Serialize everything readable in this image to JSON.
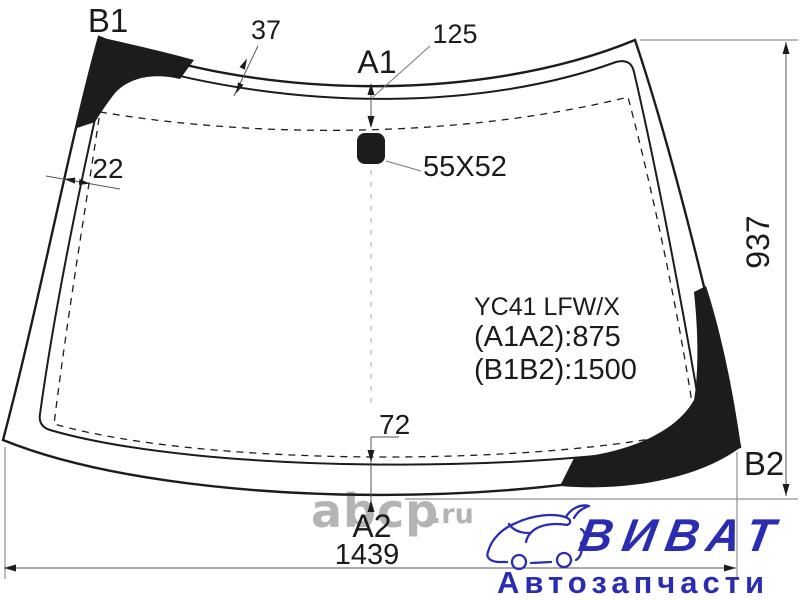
{
  "diagram": {
    "corner_labels": {
      "top_left": "B1",
      "top_center": "A1",
      "bottom_center": "A2",
      "bottom_right": "B2"
    },
    "dimensions": {
      "top_band": "37",
      "a1_edge_offset": "125",
      "side_band": "22",
      "mirror_mount": "55X52",
      "height": "937",
      "bottom_band": "72",
      "width": "1439"
    },
    "part_info": {
      "code": "YC41 LFW/X",
      "a1a2": "(A1A2):875",
      "b1b2": "(B1B2):1500"
    }
  },
  "watermark": {
    "text": "abcp",
    "suffix": ".ru"
  },
  "logo": {
    "brand": "ВИВАТ",
    "tagline": "Автозапчасти"
  },
  "colors": {
    "line": "#1c1c1c",
    "dimension_line": "#555555",
    "dashed_line": "#c6c6c6",
    "fill_black": "#141414",
    "logo_blue": "#2a2db2",
    "watermark_gray": "#b4b4b4",
    "background": "#ffffff"
  }
}
